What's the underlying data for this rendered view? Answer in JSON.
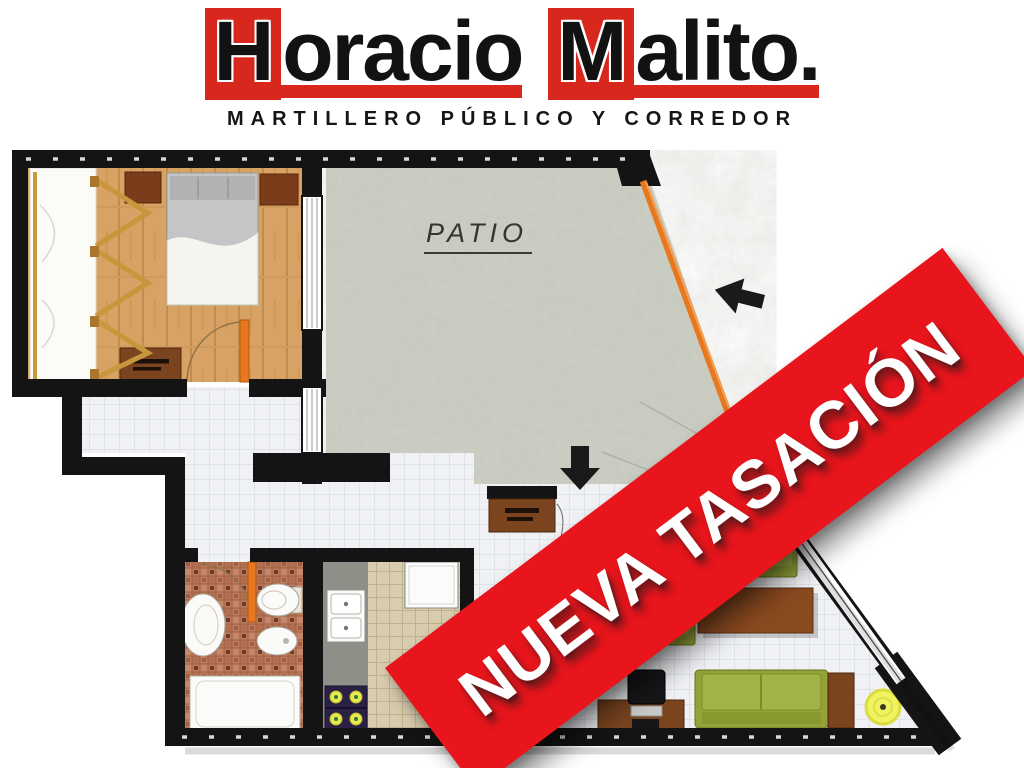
{
  "header": {
    "brand": {
      "word1": {
        "initial": "H",
        "rest": "oracio"
      },
      "word2": {
        "initial": "M",
        "rest": "alito",
        "period": "."
      }
    },
    "subtitle": "MARTILLERO PÚBLICO Y CORREDOR"
  },
  "floorplan": {
    "patio_label": "PATIO"
  },
  "banner": {
    "text": "NUEVA TASACIÓN"
  },
  "colors": {
    "logo-red": "#D8271D",
    "banner-red": "#E8151C",
    "door-orange": "#E8781F",
    "wall-black": "#141414",
    "wood-floor": "#D7A263",
    "patio-concrete": "#CDD0C5",
    "tile-white": "#F0F1F4",
    "mosaic-terracotta": "#BE7D5C",
    "kitchen-beige": "#D9CDB0",
    "counter-granite": "#8F9089",
    "sofa-green": "#97A63B",
    "furniture-brown": "#7A441F",
    "mat-yellow": "#F0F35F"
  }
}
